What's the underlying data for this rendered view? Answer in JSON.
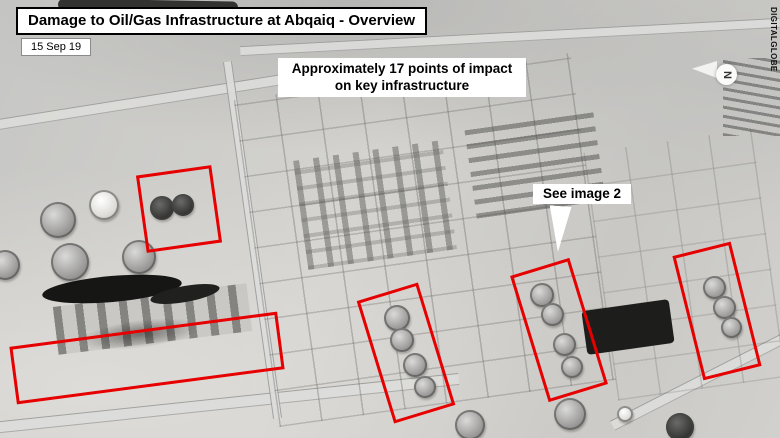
{
  "annotations": {
    "title": "Damage to Oil/Gas Infrastructure at Abqaiq - Overview",
    "date": "15 Sep 19",
    "impact_note": {
      "line1": "Approximately 17 points of impact",
      "line2": "on key infrastructure"
    },
    "callout": "See image 2",
    "credit": "DIGITALGLOBE",
    "compass_label": "N"
  },
  "markers": {
    "count": 5
  },
  "colors": {
    "marker_red": "#e60000",
    "label_bg": "#ffffff",
    "label_text": "#000000",
    "terrain_grey": "#cccbc9"
  }
}
